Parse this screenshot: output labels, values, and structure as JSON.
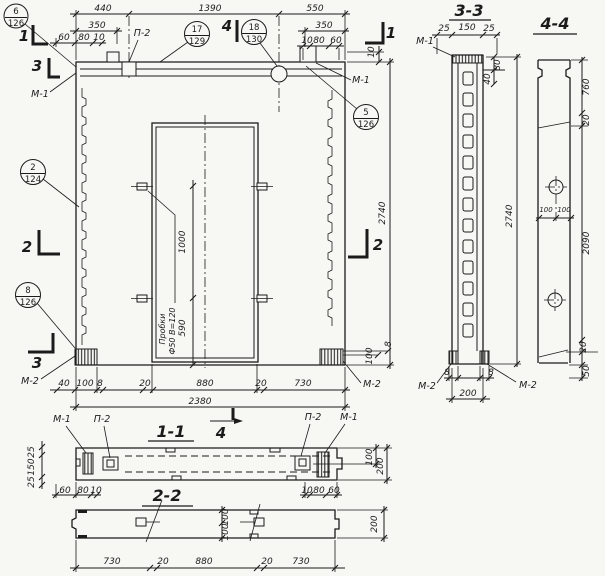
{
  "titles": {
    "s11": "1-1",
    "s22": "2-2",
    "s33": "3-3",
    "s44": "4-4"
  },
  "section_marks": {
    "c1": "1",
    "c2": "2",
    "c3": "3",
    "c4": "4"
  },
  "labels": {
    "m1": "М-1",
    "m2": "М-2",
    "p2": "П-2"
  },
  "balloons": {
    "b6": {
      "num": "6",
      "sheet": "126"
    },
    "b17": {
      "num": "17",
      "sheet": "129"
    },
    "b18": {
      "num": "18",
      "sheet": "130"
    },
    "b5": {
      "num": "5",
      "sheet": "126"
    },
    "b2": {
      "num": "2",
      "sheet": "124"
    },
    "b8": {
      "num": "8",
      "sheet": "126"
    }
  },
  "note": {
    "l1": "Пробки",
    "l2": "Ф50  В=120"
  },
  "dims": {
    "v8": "8",
    "v10": "10",
    "v20": "20",
    "v25": "25",
    "v40": "40",
    "v50": "50",
    "v60": "60",
    "v80": "80",
    "v100": "100",
    "v150": "150",
    "v200": "200",
    "v350": "350",
    "v440": "440",
    "v550": "550",
    "v590": "590",
    "v730": "730",
    "v760": "760",
    "v880": "880",
    "v1000": "1000",
    "v1390": "1390",
    "v2090": "2090",
    "v2380": "2380",
    "v2740": "2740"
  }
}
